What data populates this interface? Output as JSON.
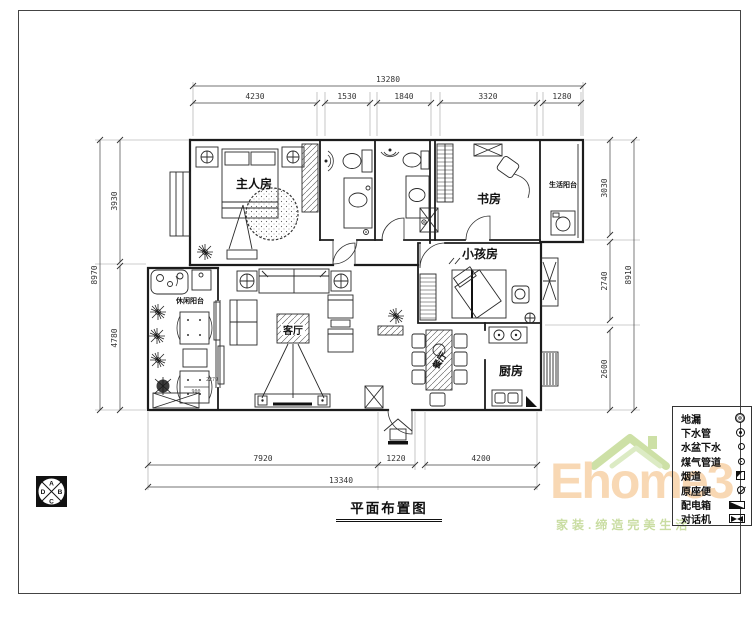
{
  "sheet": {
    "title": "平面布置图"
  },
  "compass": {
    "top": "A",
    "right": "B",
    "bottom": "C",
    "left": "D"
  },
  "rooms": {
    "master": "主人房",
    "study": "书房",
    "kids": "小孩房",
    "living": "客厅",
    "dining": "餐厅",
    "kitchen": "厨房",
    "leisure_balcony": "休闲阳台",
    "life_balcony": "生活阳台"
  },
  "dimensions": {
    "top_total": "13280",
    "top_segments": [
      "4230",
      "1530",
      "1840",
      "3320",
      "1280"
    ],
    "left_total": "8970",
    "left_segments": [
      "3930",
      "4780"
    ],
    "right_total": "8910",
    "right_segments": [
      "3030",
      "2740",
      "2600"
    ],
    "bottom_total": "13340",
    "bottom_segments": [
      "7920",
      "1220",
      "4200"
    ],
    "balcony_minor": [
      "2279",
      "900"
    ]
  },
  "legend": {
    "items": [
      {
        "label": "地漏",
        "icon": "floor-drain-icon"
      },
      {
        "label": "下水管",
        "icon": "down-pipe-icon"
      },
      {
        "label": "水盆下水",
        "icon": "basin-drain-icon"
      },
      {
        "label": "煤气管道",
        "icon": "gas-pipe-icon"
      },
      {
        "label": "烟道",
        "icon": "flue-icon"
      },
      {
        "label": "原座便",
        "icon": "toilet-icon"
      },
      {
        "label": "配电箱",
        "icon": "distribution-box-icon"
      },
      {
        "label": "对话机",
        "icon": "intercom-icon"
      }
    ]
  },
  "watermark": {
    "brand": "Ehome3",
    "slogan": "家装.缔造完美生活"
  }
}
